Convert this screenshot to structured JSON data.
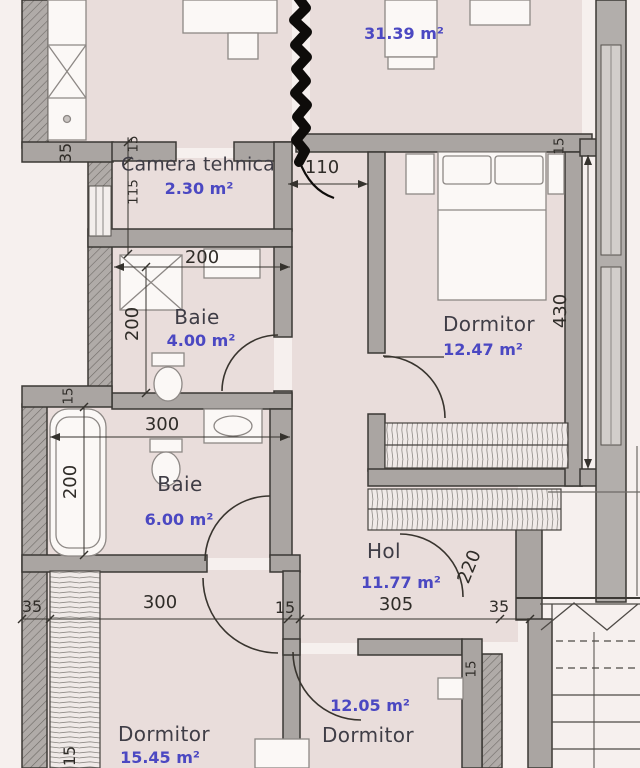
{
  "document": {
    "type": "apartment-floor-plan"
  },
  "colors": {
    "background": "#f6f0ee",
    "room_fill": "#e9dddb",
    "wall_fill": "#aaa5a2",
    "wall_outline": "#3b3834",
    "window_glazing": "#d2cecb",
    "room_name_text": "#3f3d46",
    "area_text": "#4b48c2",
    "dimension_text": "#2f2c28",
    "scribble": "#0e0c0a"
  },
  "rooms": [
    {
      "id": "living",
      "name": "",
      "area": "31.39 m²"
    },
    {
      "id": "camera-tehnica",
      "name": "Camera tehnica",
      "area": "2.30 m²"
    },
    {
      "id": "dormitor-est",
      "name": "Dormitor",
      "area": "12.47 m²"
    },
    {
      "id": "baie-mica",
      "name": "Baie",
      "area": "4.00 m²"
    },
    {
      "id": "baie-mare",
      "name": "Baie",
      "area": "6.00 m²"
    },
    {
      "id": "hol",
      "name": "Hol",
      "area": "11.77 m²"
    },
    {
      "id": "dormitor-sud-vest",
      "name": "Dormitor",
      "area": "15.45 m²"
    },
    {
      "id": "dormitor-sud",
      "name": "Dormitor",
      "area": "12.05 m²"
    }
  ],
  "dimensions": [
    {
      "value": "35"
    },
    {
      "value": "15"
    },
    {
      "value": "115"
    },
    {
      "value": "110"
    },
    {
      "value": "15"
    },
    {
      "value": "200"
    },
    {
      "value": "200"
    },
    {
      "value": "430"
    },
    {
      "value": "15"
    },
    {
      "value": "300"
    },
    {
      "value": "200"
    },
    {
      "value": "220"
    },
    {
      "value": "35"
    },
    {
      "value": "300"
    },
    {
      "value": "15"
    },
    {
      "value": "305"
    },
    {
      "value": "35"
    },
    {
      "value": "15"
    },
    {
      "value": "15"
    }
  ]
}
